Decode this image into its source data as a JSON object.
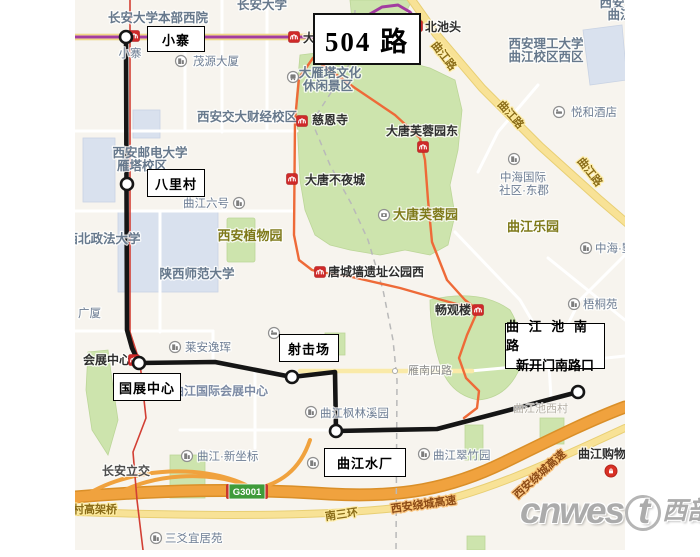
{
  "title_box": {
    "label": "504 路"
  },
  "stop_boxes": {
    "xiaozhai": "小寨",
    "balicun": "八里村",
    "shejichang": "射击场",
    "guozhanzhongxin": "国展中心",
    "qujiangshuichang": "曲江水厂",
    "terminus_line1": "曲 江 池 南 路",
    "terminus_line2": "新开门南路口"
  },
  "watermark": {
    "latin_head": "cnwes",
    "latin_t": "t",
    "cjk": "西部网"
  },
  "map": {
    "bg": "#f7f4ee",
    "route": {
      "color": "#151515",
      "width": 4.6,
      "points": [
        [
          126,
          37
        ],
        [
          127,
          330
        ],
        [
          132,
          348
        ],
        [
          139,
          363
        ],
        [
          215,
          362
        ],
        [
          292,
          377
        ],
        [
          335,
          372
        ],
        [
          336,
          431
        ],
        [
          437,
          429
        ],
        [
          578,
          392
        ]
      ]
    },
    "stations": [
      [
        126,
        37
      ],
      [
        127,
        184
      ],
      [
        139,
        363
      ],
      [
        292,
        377
      ],
      [
        336,
        431
      ],
      [
        578,
        392
      ]
    ],
    "metro_markers": [
      [
        134,
        36
      ],
      [
        294,
        37
      ],
      [
        417,
        26
      ],
      [
        302,
        121
      ],
      [
        292,
        179
      ],
      [
        423,
        147
      ],
      [
        320,
        272
      ],
      [
        478,
        310
      ],
      [
        134,
        360
      ]
    ],
    "transit_lines": [
      {
        "name": "metro-line-purple",
        "color": "#a23ca0",
        "width": 3,
        "points": [
          [
            75,
            37
          ],
          [
            330,
            37
          ],
          [
            363,
            18
          ],
          [
            382,
            7
          ],
          [
            398,
            5
          ],
          [
            410,
            12
          ],
          [
            417,
            22
          ]
        ]
      },
      {
        "name": "rail-line-red",
        "color": "#d23f34",
        "width": 1.6,
        "points": [
          [
            130,
            0
          ],
          [
            130,
            332
          ],
          [
            140,
            363
          ],
          [
            146,
            418
          ],
          [
            133,
            452
          ],
          [
            137,
            500
          ],
          [
            143,
            550
          ]
        ]
      },
      {
        "name": "park-loop-west",
        "color": "#ee6a38",
        "width": 2.4,
        "points": [
          [
            313,
            58
          ],
          [
            299,
            78
          ],
          [
            295,
            120
          ],
          [
            294,
            235
          ],
          [
            299,
            260
          ],
          [
            312,
            270
          ],
          [
            320,
            272
          ],
          [
            352,
            277
          ],
          [
            400,
            288
          ],
          [
            442,
            300
          ],
          [
            478,
            310
          ]
        ]
      },
      {
        "name": "park-loop-east",
        "color": "#ee6a38",
        "width": 2.4,
        "points": [
          [
            313,
            58
          ],
          [
            355,
            88
          ],
          [
            395,
            115
          ],
          [
            420,
            138
          ],
          [
            425,
            160
          ],
          [
            428,
            200
          ],
          [
            432,
            242
          ],
          [
            447,
            280
          ],
          [
            465,
            300
          ],
          [
            478,
            310
          ]
        ]
      },
      {
        "name": "park-loop-south",
        "color": "#ee6a38",
        "width": 2.4,
        "points": [
          [
            478,
            310
          ],
          [
            467,
            335
          ],
          [
            459,
            358
          ],
          [
            466,
            378
          ],
          [
            479,
            391
          ],
          [
            477,
            408
          ],
          [
            464,
            418
          ]
        ]
      }
    ],
    "labels": [
      {
        "t": "长安大学",
        "x": 262,
        "y": 9,
        "c": "campus",
        "a": "m"
      },
      {
        "t": "长安大学本部西院",
        "x": 158,
        "y": 22,
        "c": "campus",
        "a": "m"
      },
      {
        "t": "西安邮电大学",
        "x": 150,
        "y": 157,
        "c": "campus",
        "a": "m"
      },
      {
        "t": "雁塔校区",
        "x": 142,
        "y": 170,
        "c": "campus",
        "a": "m"
      },
      {
        "t": "西安交大财经校区",
        "x": 247,
        "y": 121,
        "c": "campus",
        "a": "m"
      },
      {
        "t": "西北政法大学",
        "x": 103,
        "y": 243,
        "c": "campus",
        "a": "m"
      },
      {
        "t": "陕西师范大学",
        "x": 197,
        "y": 278,
        "c": "campus",
        "a": "m"
      },
      {
        "t": "西安理工大学",
        "x": 546,
        "y": 48,
        "c": "campus",
        "a": "m"
      },
      {
        "t": "曲江校区西区",
        "x": 546,
        "y": 61,
        "c": "campus",
        "a": "m"
      },
      {
        "t": "大雁塔文化",
        "x": 330,
        "y": 77,
        "c": "campus",
        "a": "m"
      },
      {
        "t": "休闲景区",
        "x": 328,
        "y": 90,
        "c": "campus",
        "a": "m"
      },
      {
        "t": "西安",
        "x": 612,
        "y": 7,
        "c": "campus",
        "a": "m"
      },
      {
        "t": "曲江",
        "x": 620,
        "y": 19,
        "c": "campus",
        "a": "m"
      },
      {
        "t": "小寨",
        "x": 130,
        "y": 57,
        "c": "poi",
        "a": "m"
      },
      {
        "t": "北池头",
        "x": 425,
        "y": 31,
        "c": "metro",
        "a": "s"
      },
      {
        "t": "大",
        "x": 303,
        "y": 42,
        "c": "metro",
        "a": "s"
      },
      {
        "t": "慈恩寺",
        "x": 312,
        "y": 124,
        "c": "metro",
        "a": "s"
      },
      {
        "t": "大唐不夜城",
        "x": 305,
        "y": 184,
        "c": "metro",
        "a": "s"
      },
      {
        "t": "大唐芙蓉园东",
        "x": 422,
        "y": 135,
        "c": "metro",
        "a": "m"
      },
      {
        "t": "唐城墙遗址公园西",
        "x": 328,
        "y": 276,
        "c": "metro",
        "a": "s"
      },
      {
        "t": "畅观楼",
        "x": 435,
        "y": 314,
        "c": "metro",
        "a": "s"
      },
      {
        "t": "会展中心",
        "x": 83,
        "y": 364,
        "c": "metro",
        "a": "s"
      },
      {
        "t": "曲江购物中心",
        "x": 578,
        "y": 458,
        "c": "metro",
        "a": "s"
      },
      {
        "t": "西安植物园",
        "x": 250,
        "y": 240,
        "c": "park",
        "a": "m"
      },
      {
        "t": "曲江乐园",
        "x": 533,
        "y": 231,
        "c": "park",
        "a": "m"
      },
      {
        "t": "大唐芙蓉园",
        "x": 393,
        "y": 219,
        "c": "park",
        "a": "s"
      },
      {
        "t": "茂源大厦",
        "x": 193,
        "y": 65,
        "c": "poi",
        "a": "s"
      },
      {
        "t": "悦和酒店",
        "x": 571,
        "y": 116,
        "c": "poi",
        "a": "s"
      },
      {
        "t": "中海国际",
        "x": 523,
        "y": 181,
        "c": "poi",
        "a": "m"
      },
      {
        "t": "社区·东郡",
        "x": 524,
        "y": 194,
        "c": "poi",
        "a": "m"
      },
      {
        "t": "曲江六号",
        "x": 206,
        "y": 207,
        "c": "poi",
        "a": "m"
      },
      {
        "t": "中海·墅",
        "x": 595,
        "y": 252,
        "c": "poi",
        "a": "s"
      },
      {
        "t": "梧桐苑",
        "x": 583,
        "y": 308,
        "c": "poi",
        "a": "s"
      },
      {
        "t": "广厦",
        "x": 78,
        "y": 317,
        "c": "poi",
        "a": "s"
      },
      {
        "t": "莱安逸珲",
        "x": 185,
        "y": 351,
        "c": "poi",
        "a": "s"
      },
      {
        "t": "曲江国际会展中心",
        "x": 172,
        "y": 395,
        "c": "poi-bold",
        "a": "s"
      },
      {
        "t": "曲江枫林溪园",
        "x": 320,
        "y": 417,
        "c": "poi",
        "a": "s"
      },
      {
        "t": "曲江翠竹园",
        "x": 433,
        "y": 459,
        "c": "poi",
        "a": "s"
      },
      {
        "t": "曲江·新坐标",
        "x": 197,
        "y": 460,
        "c": "poi",
        "a": "s"
      },
      {
        "t": "三爻宜居苑",
        "x": 165,
        "y": 542,
        "c": "poi",
        "a": "s"
      },
      {
        "t": "曲江池西村",
        "x": 513,
        "y": 412,
        "c": "faint",
        "a": "s"
      },
      {
        "t": "曲江路",
        "x": 441,
        "y": 58,
        "c": "road-y",
        "a": "m",
        "r": 52
      },
      {
        "t": "曲江路",
        "x": 508,
        "y": 117,
        "c": "road-y",
        "a": "m",
        "r": 48
      },
      {
        "t": "曲江路",
        "x": 587,
        "y": 174,
        "c": "road-y",
        "a": "m",
        "r": 52
      },
      {
        "t": "南三环",
        "x": 342,
        "y": 518,
        "c": "road-y",
        "a": "m",
        "r": -8
      },
      {
        "t": "三爻村高架桥",
        "x": 51,
        "y": 513,
        "c": "road-y",
        "a": "s"
      },
      {
        "t": "西安绕城高速",
        "x": 424,
        "y": 508,
        "c": "hw",
        "a": "m",
        "r": -8
      },
      {
        "t": "西安绕城高速",
        "x": 542,
        "y": 477,
        "c": "hw",
        "a": "m",
        "r": -42
      },
      {
        "t": "长安立交",
        "x": 102,
        "y": 475,
        "c": "roadname",
        "a": "s"
      },
      {
        "t": "雁南四路",
        "x": 408,
        "y": 374,
        "c": "road-gray",
        "a": "s"
      }
    ],
    "poi_icons": [
      {
        "x": 181,
        "y": 61,
        "k": "building"
      },
      {
        "x": 293,
        "y": 77,
        "k": "bus"
      },
      {
        "x": 559,
        "y": 112,
        "k": "hotel"
      },
      {
        "x": 514,
        "y": 159,
        "k": "building"
      },
      {
        "x": 239,
        "y": 203,
        "k": "building"
      },
      {
        "x": 586,
        "y": 248,
        "k": "building"
      },
      {
        "x": 574,
        "y": 304,
        "k": "building"
      },
      {
        "x": 175,
        "y": 347,
        "k": "building"
      },
      {
        "x": 384,
        "y": 215,
        "k": "attraction"
      },
      {
        "x": 311,
        "y": 412,
        "k": "building"
      },
      {
        "x": 424,
        "y": 454,
        "k": "building"
      },
      {
        "x": 187,
        "y": 456,
        "k": "building"
      },
      {
        "x": 156,
        "y": 538,
        "k": "building"
      },
      {
        "x": 313,
        "y": 463,
        "k": "building"
      },
      {
        "x": 274,
        "y": 333,
        "k": "hotel"
      },
      {
        "x": 611,
        "y": 471,
        "k": "shopping"
      }
    ],
    "highway_badge": {
      "text": "G3001",
      "x": 229,
      "y": 484,
      "w": 36,
      "h": 15,
      "bg": "#3f9b3a",
      "cap": "#c8372d"
    }
  }
}
